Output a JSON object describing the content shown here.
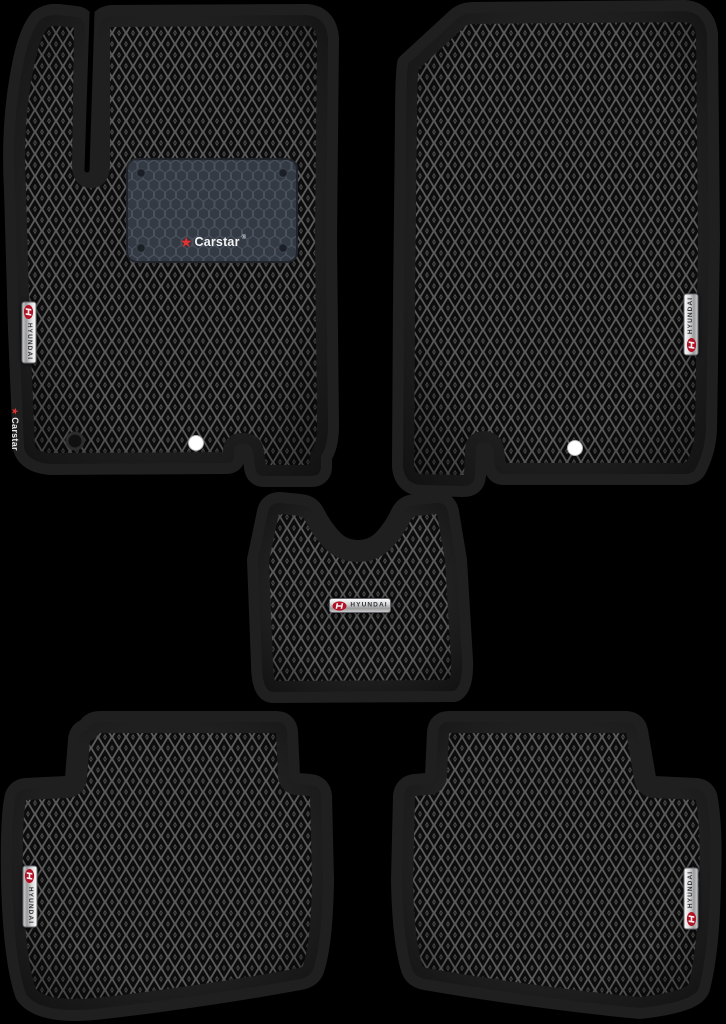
{
  "scene": {
    "background": "#000000",
    "description": "Five-piece black EVA car floor mat set with rhombus cell pattern: two front mats, one centre tunnel mat, two rear mats"
  },
  "colors": {
    "mat_cell": "#0c0c0c",
    "mat_lattice": "#5a5a5a",
    "mat_border": "#1f1f1f",
    "heel_pad": "#333a43",
    "heel_hex_line": "#49515d",
    "badge_silver": "#d6d6d6",
    "badge_text": "#33363a",
    "hyundai_red": "#b11226",
    "star_red": "#e03434",
    "fastener_white": "#ffffff"
  },
  "branding": {
    "carstar": "Carstar",
    "reg": "®",
    "hyundai": "HYUNDAI",
    "star": "★"
  },
  "mats": {
    "front_left": {
      "name": "Driver front mat",
      "badges": [
        "carstar-heel-pad",
        "hyundai-vertical",
        "carstar-side-label"
      ]
    },
    "front_right": {
      "name": "Passenger front mat",
      "badges": [
        "hyundai-vertical"
      ]
    },
    "tunnel": {
      "name": "Centre tunnel mat",
      "badges": [
        "hyundai-horizontal"
      ]
    },
    "rear_left": {
      "name": "Rear left mat",
      "badges": [
        "hyundai-vertical"
      ]
    },
    "rear_right": {
      "name": "Rear right mat",
      "badges": [
        "hyundai-vertical"
      ]
    }
  }
}
